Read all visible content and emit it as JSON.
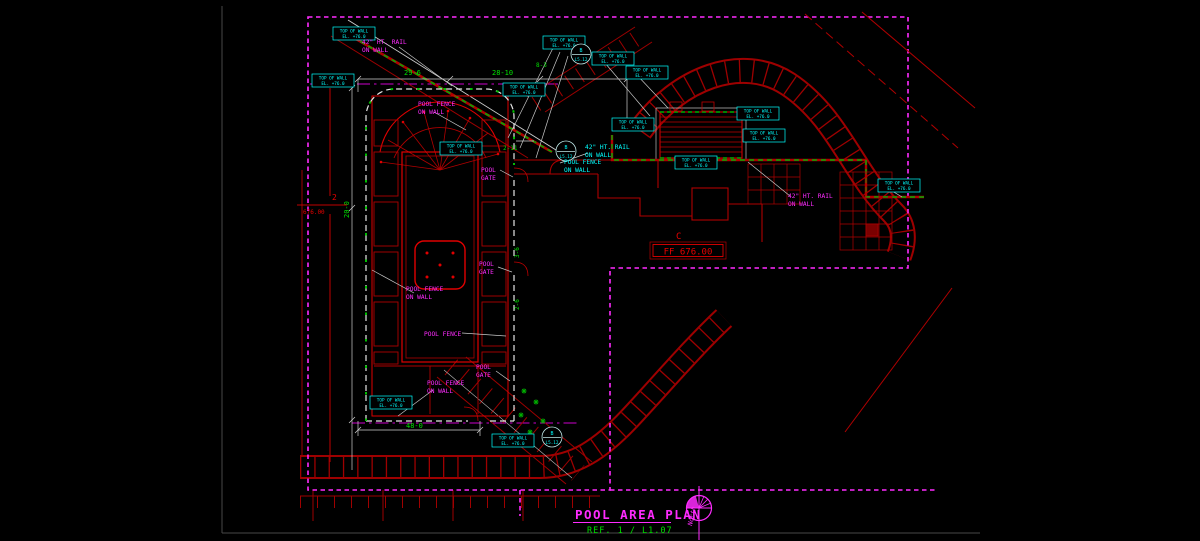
{
  "colors": {
    "background": "#000000",
    "boundary_magenta": "#ff2bff",
    "cad_red_dim": "#9e0000",
    "cad_red_bright": "#e00000",
    "callout_cyan": "#00ffff",
    "dimension_green": "#00e000",
    "rail_green_dash": "#00b000",
    "leader_white": "#c8c8c8"
  },
  "titleblock": {
    "title": "POOL AREA PLAN",
    "reference": "REF. 1 / L1.07",
    "north_label": "North"
  },
  "markers": {
    "ff_letter": "C",
    "ff_value": "FF 676.00",
    "level_number": "2",
    "level_value": "676.00"
  },
  "callout": {
    "line1": "TOP OF WALL",
    "line2": "EL. +76.0"
  },
  "detail_bubble": {
    "letter": "B",
    "sheet": "L5.12"
  },
  "labels": {
    "rail_line1": "42\" HT. RAIL",
    "rail_line2": "ON WALL",
    "pool_fence_wall_line1": "POOL FENCE",
    "pool_fence_wall_line2": "ON WALL",
    "pool_gate_line1": "POOL",
    "pool_gate_line2": "GATE",
    "pool_fence": "POOL FENCE"
  },
  "dimensions": {
    "top_left": "29-6",
    "top_right": "28-10",
    "upper_small": "8-3",
    "gate_offset": "2-11",
    "bottom_width": "48-0",
    "left_height": "20-0",
    "right_side_a": "3-6",
    "right_side_b": "2-6"
  }
}
